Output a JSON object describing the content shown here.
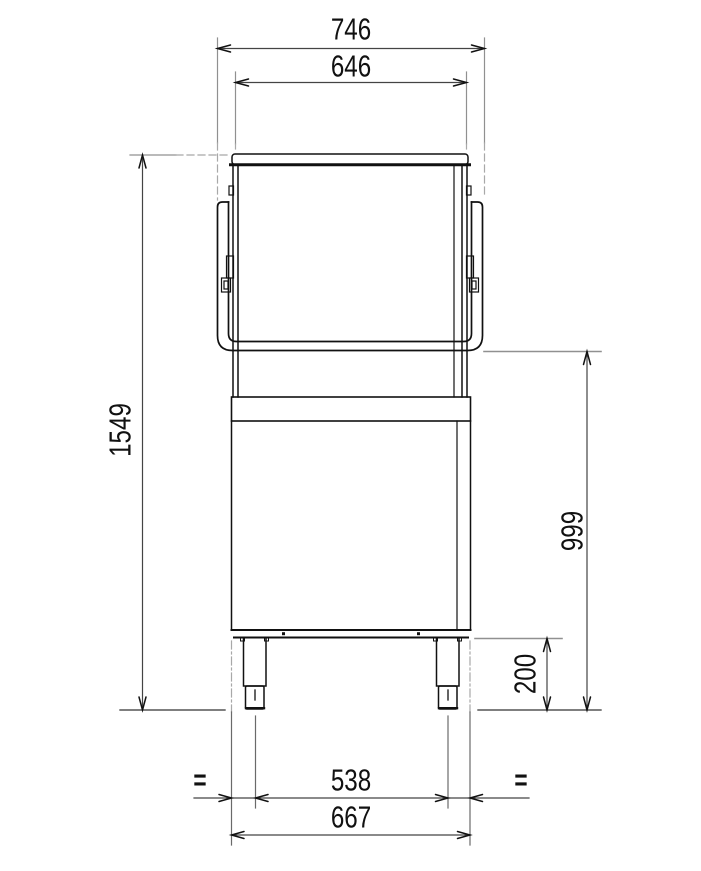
{
  "drawing": {
    "type": "technical-dimension-drawing",
    "subject": "hood-type commercial dishwasher, front elevation",
    "units": "mm",
    "labels": {
      "top_outer_width": "746",
      "top_inner_width": "646",
      "overall_height": "1549",
      "working_height": "999",
      "leg_height": "200",
      "leg_spacing": "538",
      "base_width": "667",
      "equal_left": "=",
      "equal_right": "="
    },
    "colors": {
      "outline": "#111111",
      "dimension_line": "#444444",
      "extension_line": "#909090",
      "text": "#111111",
      "background": "#ffffff"
    }
  }
}
